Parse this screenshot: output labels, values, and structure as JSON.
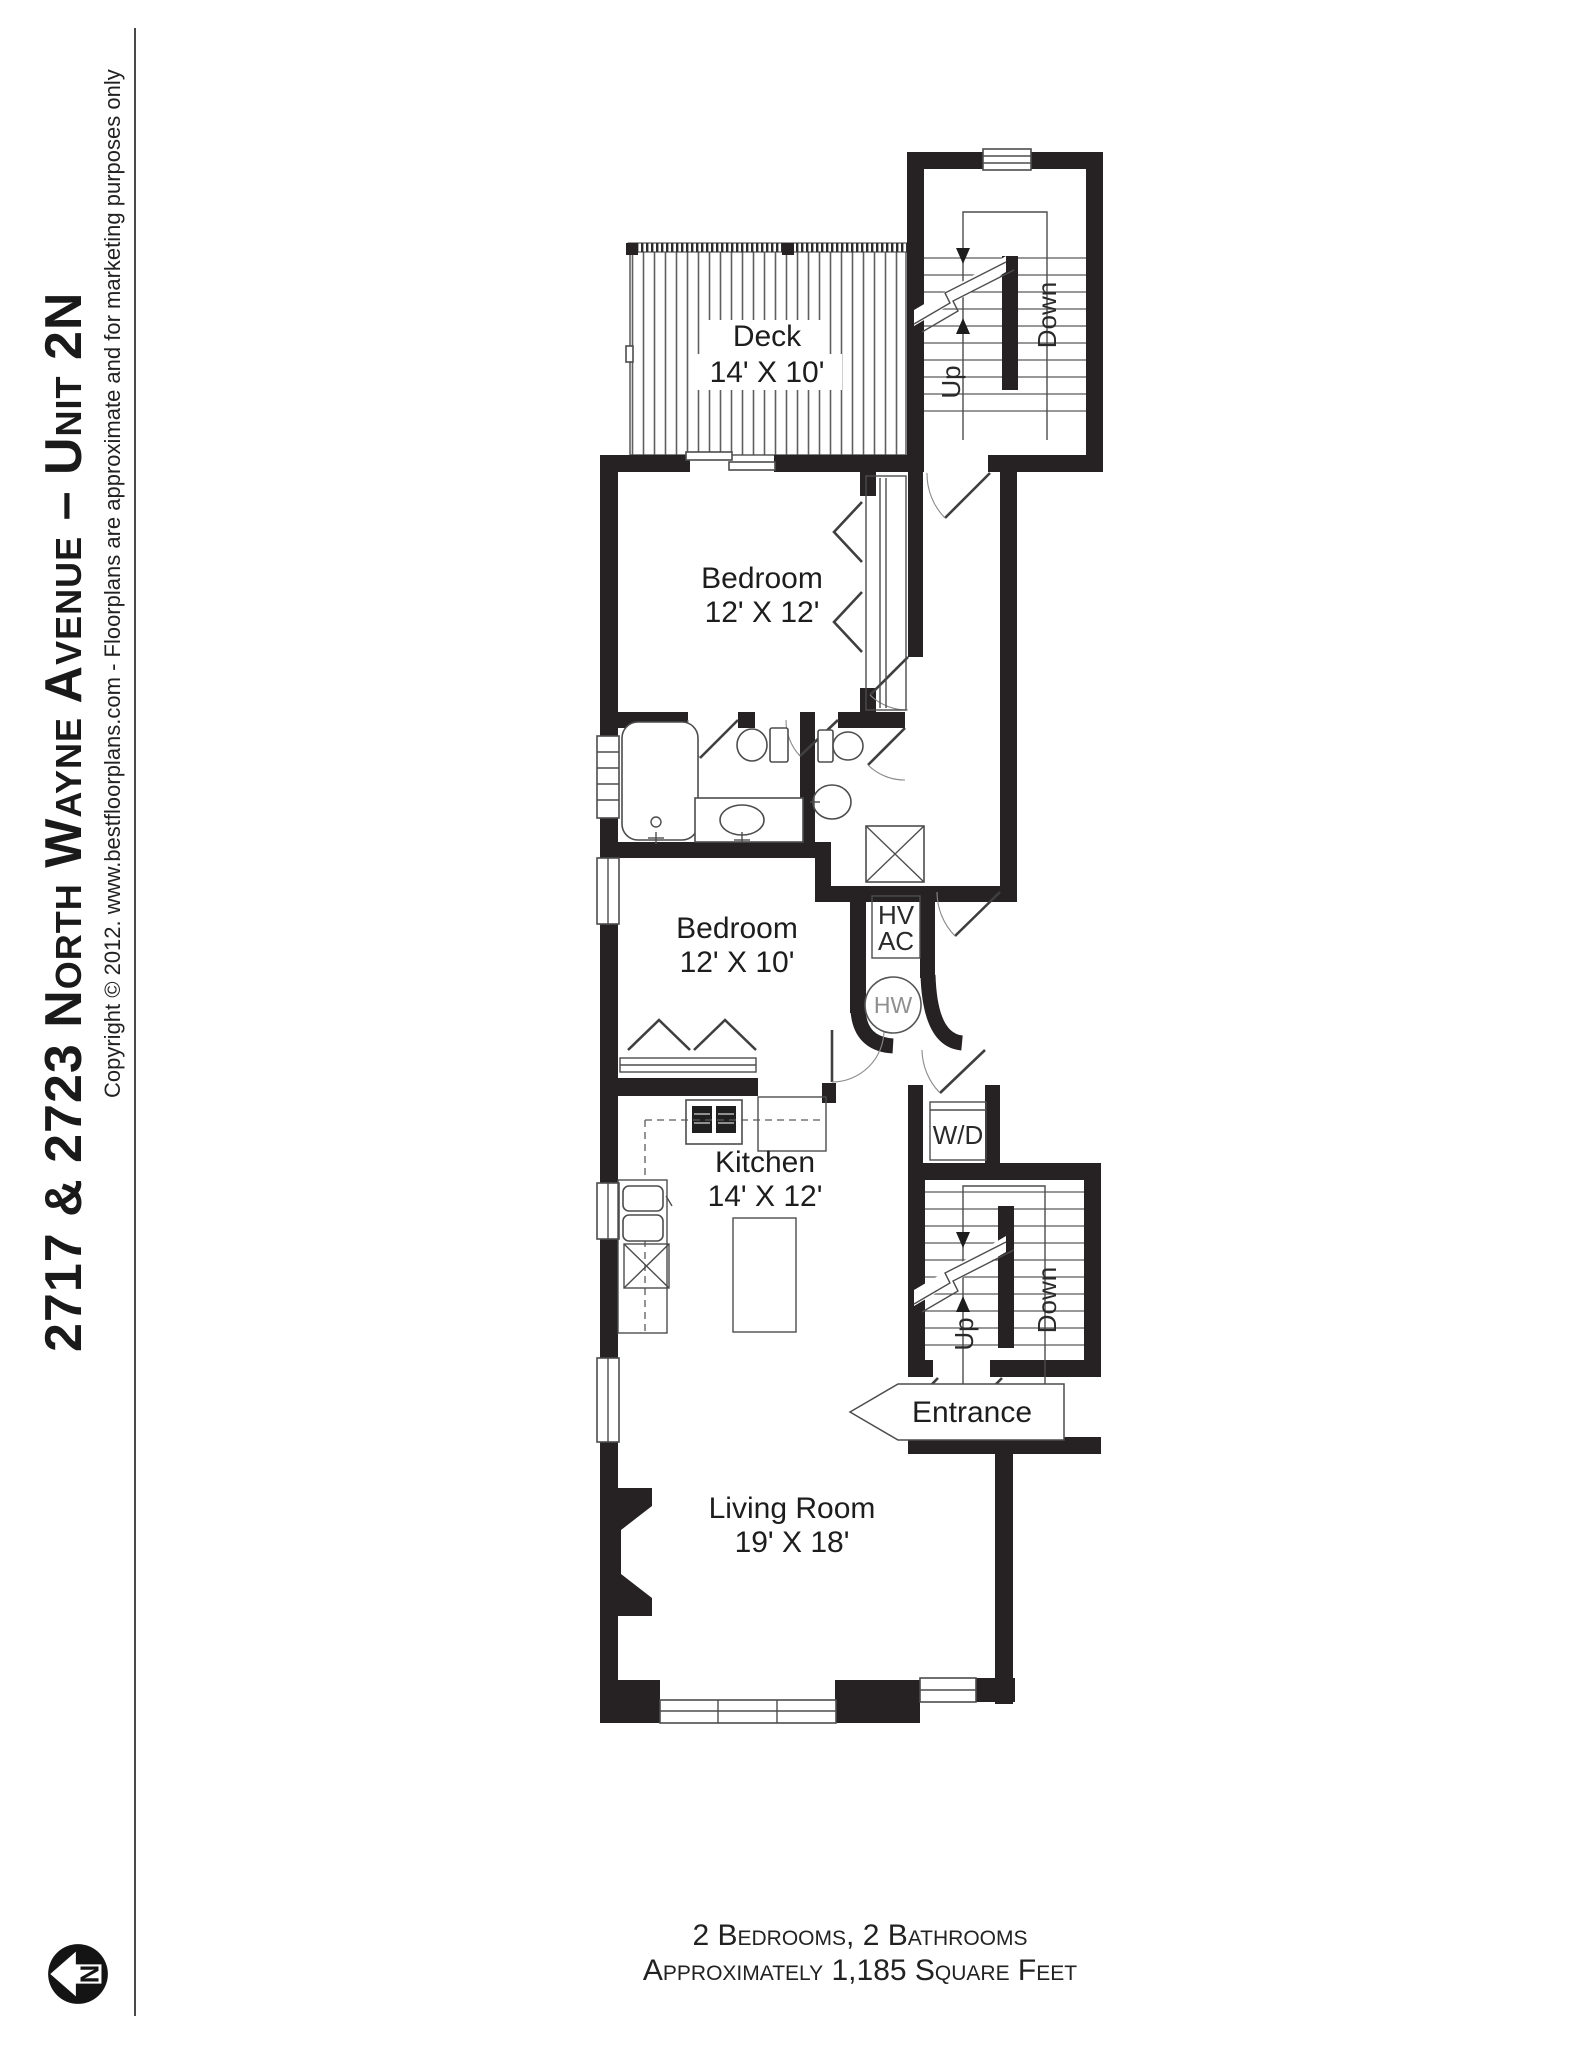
{
  "meta": {
    "background": "#ffffff",
    "wall_color": "#262122",
    "line_color": "#4d4d4d"
  },
  "sidebar": {
    "title": "2717 & 2723 North Wayne Avenue – Unit 2N",
    "copyright": "Copyright © 2012. www.bestfloorplans.com - Floorplans are approximate and for marketing purposes only",
    "compass_letter": "N"
  },
  "rooms": {
    "deck": {
      "name": "Deck",
      "dims": "14' X 10'"
    },
    "bedroom1": {
      "name": "Bedroom",
      "dims": "12' X 12'"
    },
    "bedroom2": {
      "name": "Bedroom",
      "dims": "12' X 10'"
    },
    "kitchen": {
      "name": "Kitchen",
      "dims": "14' X 12'"
    },
    "living_room": {
      "name": "Living Room",
      "dims": "19' X 18'"
    }
  },
  "stairs": {
    "up": "Up",
    "down": "Down"
  },
  "labels": {
    "entrance": "Entrance",
    "washer_dryer": "W/D",
    "hvac_line1": "HV",
    "hvac_line2": "AC",
    "water_heater": "HW"
  },
  "footer": {
    "line1": "2 Bedrooms, 2 Bathrooms",
    "line2": "Approximately 1,185 Square Feet"
  }
}
